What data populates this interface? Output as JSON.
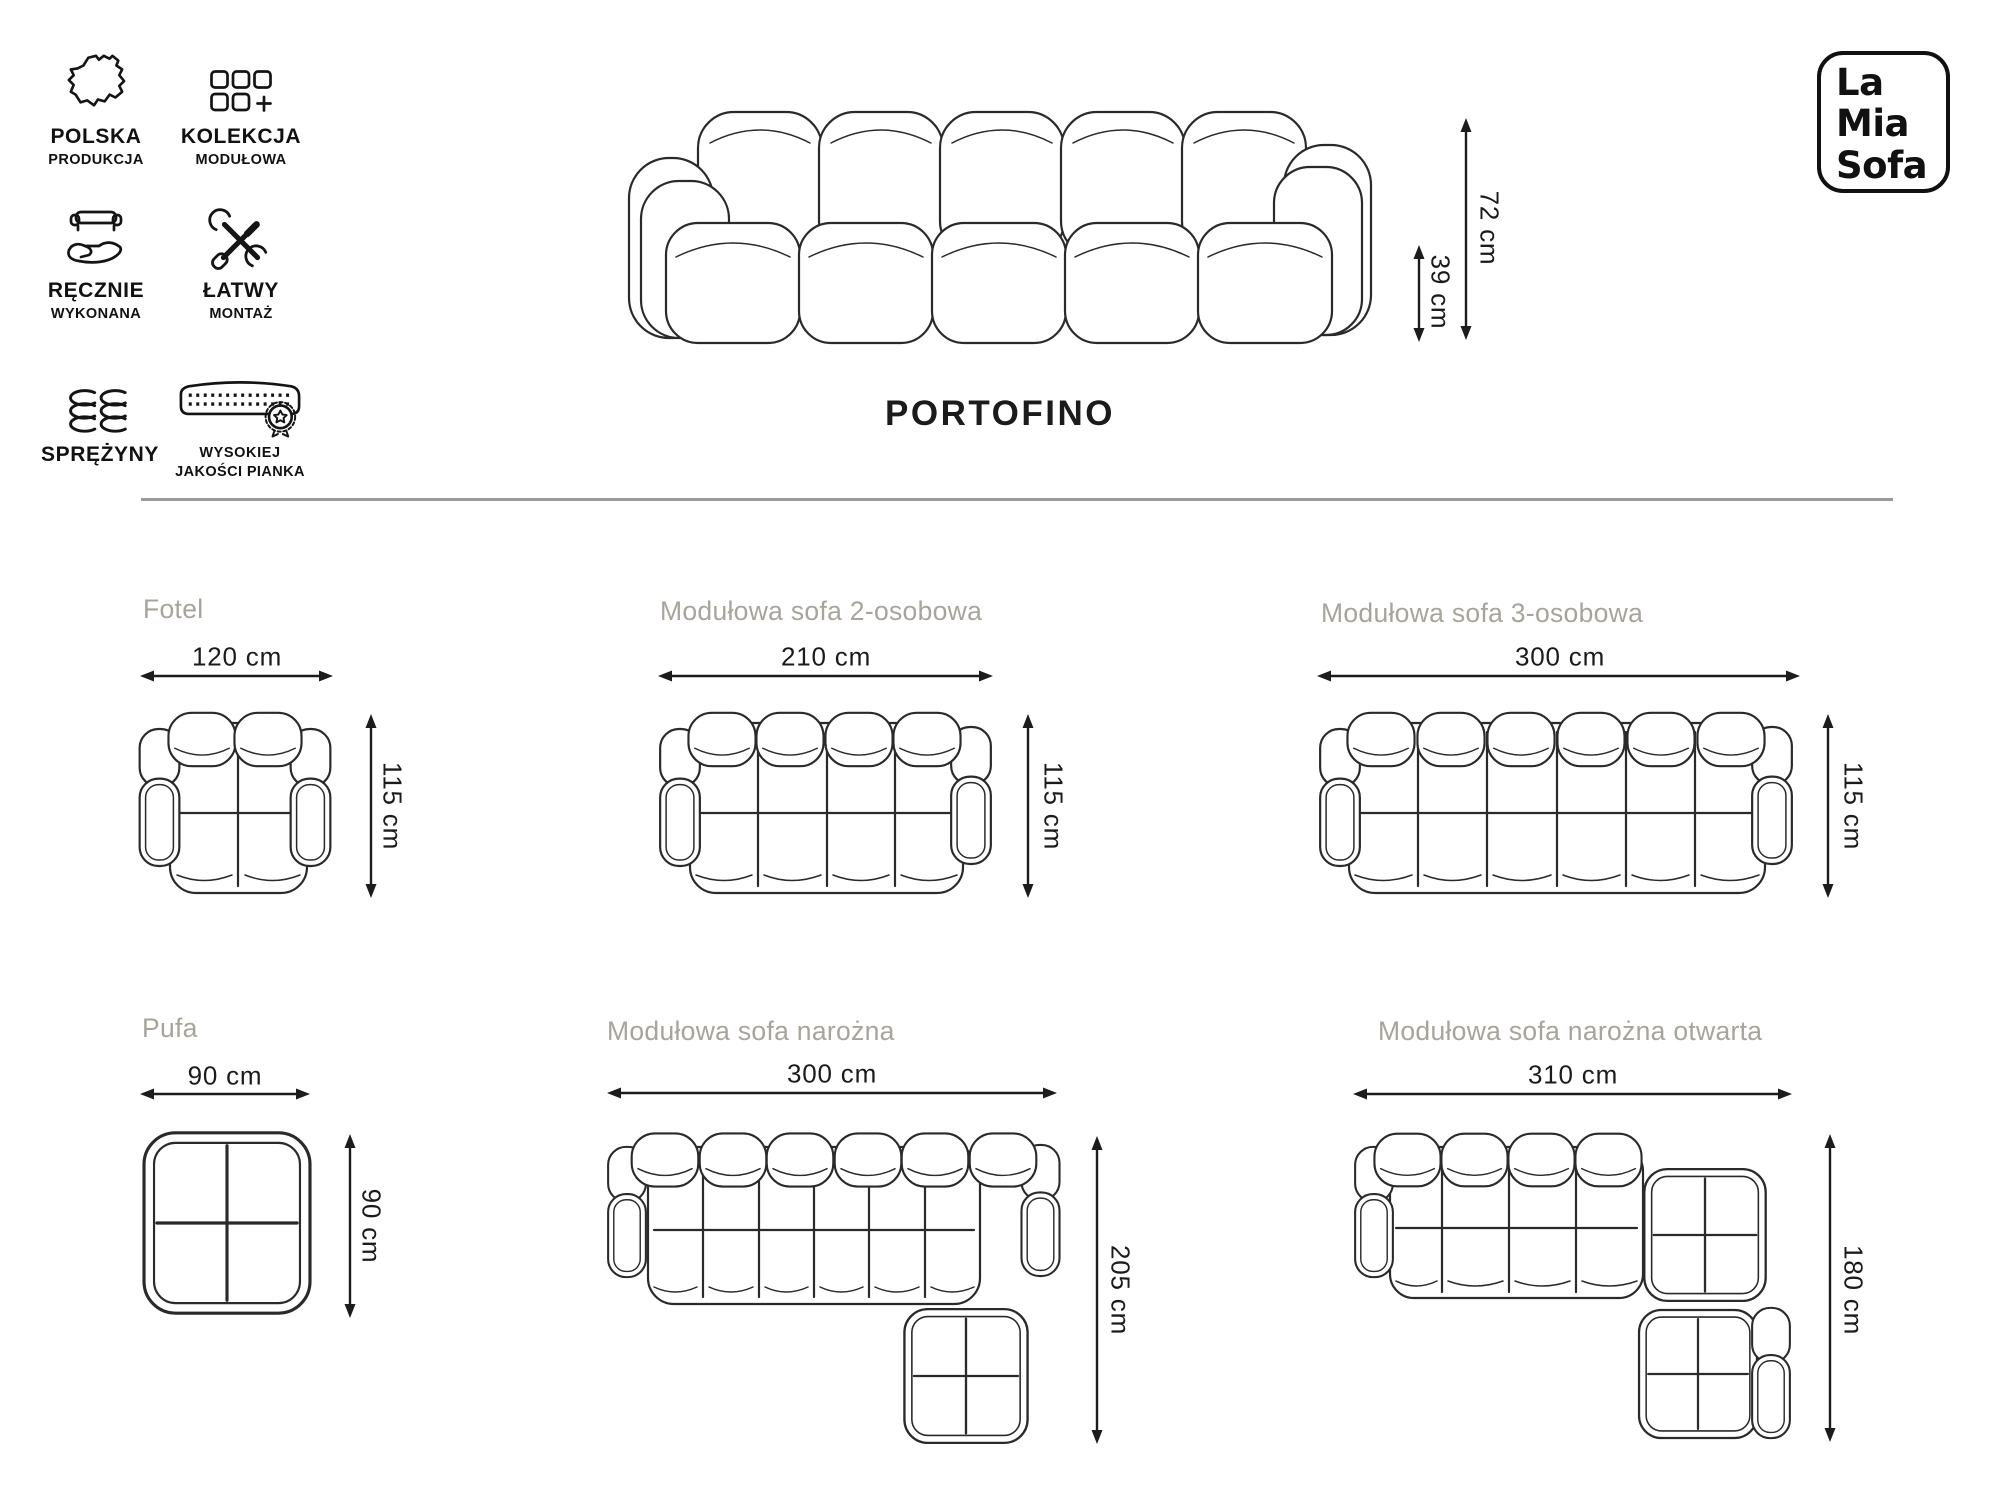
{
  "logo": {
    "lines": [
      "La",
      "Mia",
      "Sofa"
    ]
  },
  "title": "PORTOFINO",
  "features": [
    {
      "icon": "poland-map-icon",
      "lines": [
        "POLSKA",
        "PRODUKCJA"
      ]
    },
    {
      "icon": "modular-collection-icon",
      "lines": [
        "KOLEKCJA",
        "MODUŁOWA"
      ]
    },
    {
      "icon": "handmade-sofa-icon",
      "lines": [
        "RĘCZNIE",
        "WYKONANA"
      ]
    },
    {
      "icon": "easy-assembly-icon",
      "lines": [
        "ŁATWY",
        "MONTAŻ"
      ]
    },
    {
      "icon": "springs-icon",
      "lines": [
        "SPRĘŻYNY"
      ]
    },
    {
      "icon": "high-quality-foam-icon",
      "lines": [
        "WYSOKIEJ",
        "JAKOŚCI PIANKA"
      ]
    }
  ],
  "side_view": {
    "total_height": "72 cm",
    "seat_height": "39 cm"
  },
  "variants": {
    "fotel": {
      "name": "Fotel",
      "width": "120 cm",
      "depth": "115 cm"
    },
    "sofa2": {
      "name": "Modułowa sofa 2-osobowa",
      "width": "210 cm",
      "depth": "115 cm"
    },
    "sofa3": {
      "name": "Modułowa sofa 3-osobowa",
      "width": "300 cm",
      "depth": "115 cm"
    },
    "pufa": {
      "name": "Pufa",
      "width": "90 cm",
      "depth": "90 cm"
    },
    "narozna": {
      "name": "Modułowa sofa narożna",
      "width": "300 cm",
      "depth": "205 cm"
    },
    "otwarta": {
      "name": "Modułowa sofa narożna otwarta",
      "width": "310 cm",
      "depth": "180 cm"
    }
  },
  "colors": {
    "ink": "#1e1e1e",
    "line": "#2a2a2a",
    "heading": "#a8a49c",
    "divider": "#9a9a9a",
    "background": "#ffffff"
  }
}
